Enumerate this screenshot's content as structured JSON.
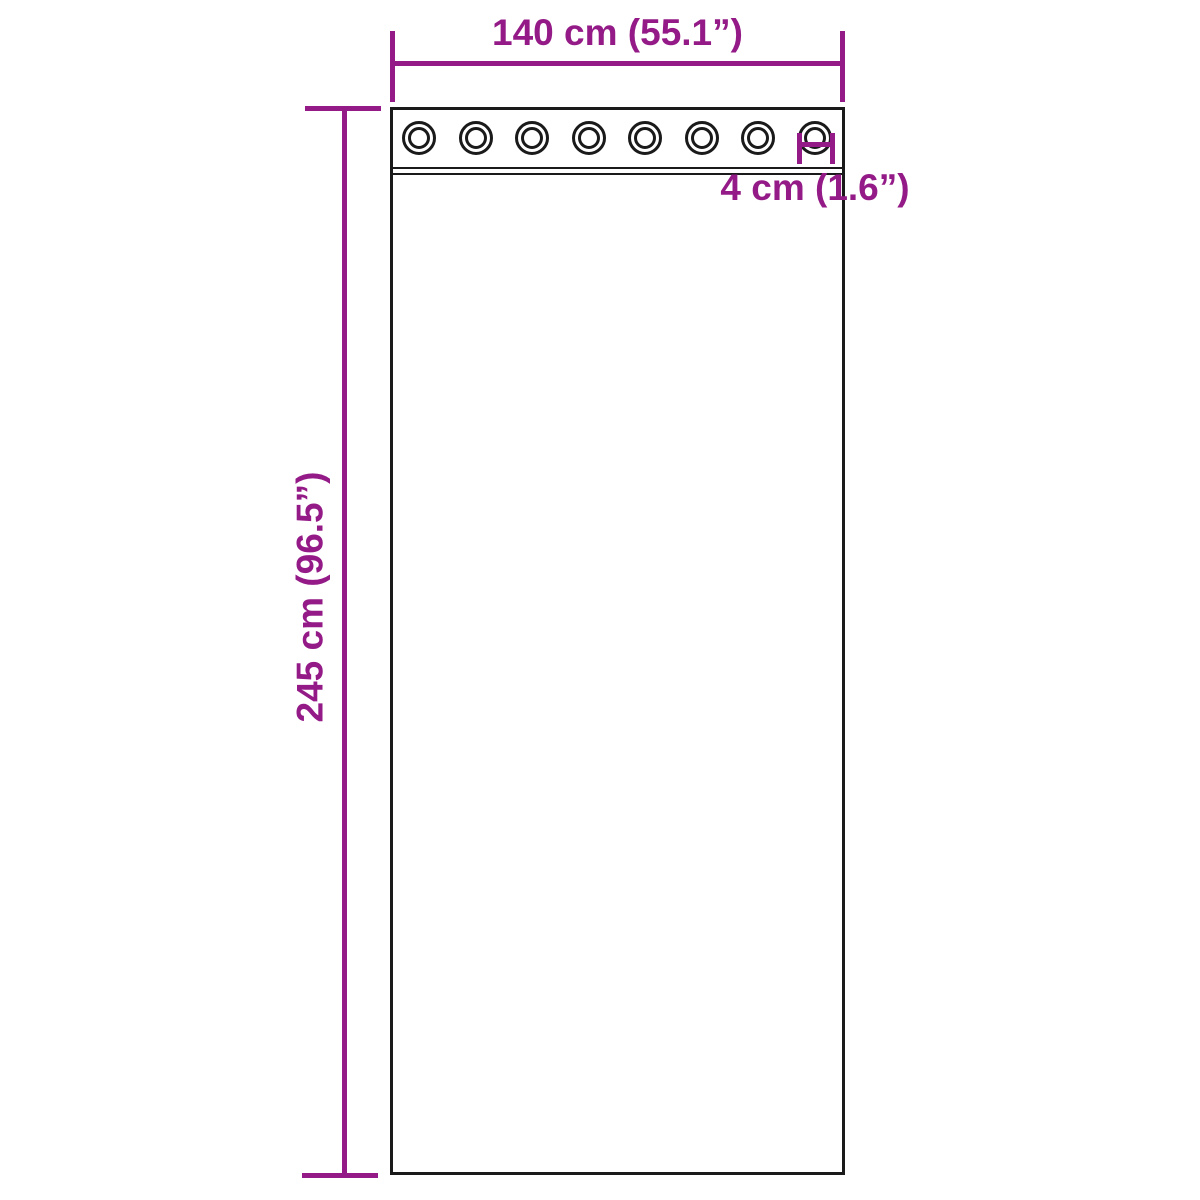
{
  "diagram": {
    "name": "curtain-with-grommets-dimension-diagram",
    "labels": {
      "width": "140 cm (55.1”)",
      "height": "245 cm (96.5”)",
      "grommet": "4 cm (1.6”)"
    },
    "grommets": {
      "count": 8
    },
    "colors": {
      "dimension_accent": "#941b87",
      "outline": "#1a1a1a",
      "background": "#ffffff"
    }
  }
}
